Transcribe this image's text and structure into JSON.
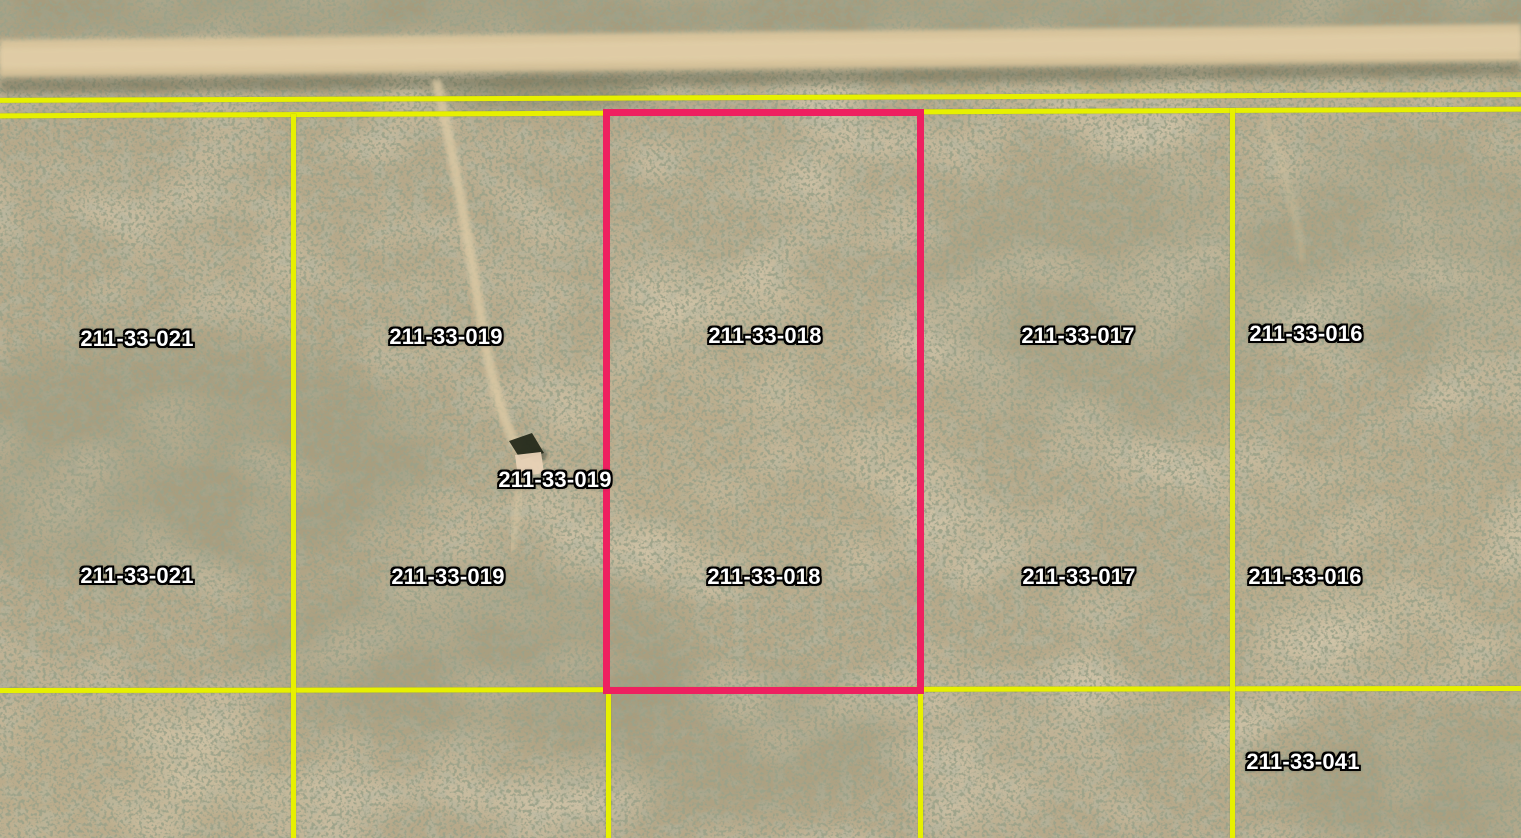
{
  "view": {
    "type": "satellite-parcel-map",
    "description": "aerial desert imagery with parcel boundary overlay and dirt road along top"
  },
  "colors": {
    "boundary": "#e7f000",
    "highlight": "#ee2060",
    "label_fill": "#ffffff",
    "label_outline": "#000000"
  },
  "parcels": {
    "highlighted": "211-33-018",
    "ids": [
      "211-33-021",
      "211-33-019",
      "211-33-018",
      "211-33-017",
      "211-33-016",
      "211-33-041"
    ]
  },
  "labels": [
    {
      "text": "211-33-021",
      "x": 137,
      "y": 339
    },
    {
      "text": "211-33-019",
      "x": 446,
      "y": 337
    },
    {
      "text": "211-33-018",
      "x": 765,
      "y": 336
    },
    {
      "text": "211-33-017",
      "x": 1078,
      "y": 336
    },
    {
      "text": "211-33-016",
      "x": 1306,
      "y": 334
    },
    {
      "text": "211-33-019",
      "x": 555,
      "y": 480
    },
    {
      "text": "211-33-021",
      "x": 137,
      "y": 576
    },
    {
      "text": "211-33-019",
      "x": 448,
      "y": 577
    },
    {
      "text": "211-33-018",
      "x": 764,
      "y": 577
    },
    {
      "text": "211-33-017",
      "x": 1079,
      "y": 577
    },
    {
      "text": "211-33-016",
      "x": 1305,
      "y": 577
    },
    {
      "text": "211-33-041",
      "x": 1303,
      "y": 762
    }
  ]
}
